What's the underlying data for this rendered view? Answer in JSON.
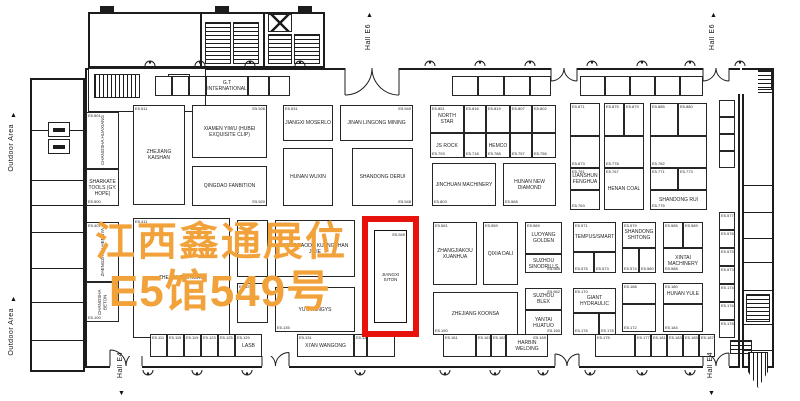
{
  "overlay": {
    "line1": "江西鑫通展位",
    "line2": "E5馆549号"
  },
  "colors": {
    "overlay_text": "#F2A23B",
    "highlight_red": "#E8120D",
    "line": "#1c1c1c"
  },
  "labels": {
    "hall_e6": "Hall E6",
    "hall_e4": "Hall E4",
    "outdoor_area": "Outdoor Area",
    "up_arrow": "▲",
    "down_arrow": "▼"
  },
  "highlight": {
    "num": "E5.549",
    "label": "JIANGXI SITON"
  },
  "booths": [
    {
      "x": 86,
      "y": 112,
      "w": 33,
      "h": 57,
      "label": "CHANGSHA HUAXIANG",
      "num": "E5.501",
      "pos": "tl",
      "vert": 1
    },
    {
      "x": 86,
      "y": 169,
      "w": 33,
      "h": 37,
      "label": "SHARKATE TOOLS (GY. HOPE)",
      "num": "E5.500",
      "pos": "bl"
    },
    {
      "x": 133,
      "y": 105,
      "w": 52,
      "h": 100,
      "label": "ZHEJIANG KAISHAN",
      "num": "E5.511",
      "pos": "tl"
    },
    {
      "x": 192,
      "y": 105,
      "w": 75,
      "h": 53,
      "label": "XIAMEN YIWU (HUBEI EXQUISITE CLIP)",
      "num": "E5.526",
      "pos": "tr"
    },
    {
      "x": 192,
      "y": 166,
      "w": 75,
      "h": 40,
      "label": "QINGDAO FANBITION",
      "num": "E5.520",
      "pos": "br"
    },
    {
      "x": 283,
      "y": 105,
      "w": 50,
      "h": 36,
      "label": "JIANGXI MOSERLO",
      "num": "E5.531",
      "pos": "tl"
    },
    {
      "x": 340,
      "y": 105,
      "w": 73,
      "h": 36,
      "label": "JINAN LINGONG MINING",
      "num": "E5.540",
      "pos": "tr"
    },
    {
      "x": 283,
      "y": 148,
      "w": 50,
      "h": 58,
      "label": "HUNAN WUXIN"
    },
    {
      "x": 352,
      "y": 148,
      "w": 61,
      "h": 58,
      "label": "SHANDONG DERUI",
      "num": "E5.548",
      "pos": "br"
    },
    {
      "x": 430,
      "y": 105,
      "w": 34,
      "h": 28,
      "label": "NORTH STAR",
      "num": "E5.851",
      "pos": "tl"
    },
    {
      "x": 464,
      "y": 105,
      "w": 22,
      "h": 28,
      "num": "E5.816",
      "pos": "tl"
    },
    {
      "x": 486,
      "y": 105,
      "w": 24,
      "h": 28,
      "num": "E5.819",
      "pos": "tl"
    },
    {
      "x": 510,
      "y": 105,
      "w": 22,
      "h": 28,
      "num": "E5.807",
      "pos": "tl"
    },
    {
      "x": 532,
      "y": 105,
      "w": 24,
      "h": 28,
      "num": "E5.802",
      "pos": "tl"
    },
    {
      "x": 430,
      "y": 133,
      "w": 34,
      "h": 25,
      "label": "JS ROCK",
      "num": "E5.793",
      "pos": "bl"
    },
    {
      "x": 464,
      "y": 133,
      "w": 22,
      "h": 25,
      "num": "E5.718",
      "pos": "bl"
    },
    {
      "x": 486,
      "y": 133,
      "w": 24,
      "h": 25,
      "label": "HEMCO",
      "num": "E5.788",
      "pos": "bl"
    },
    {
      "x": 510,
      "y": 133,
      "w": 22,
      "h": 25,
      "num": "E5.757",
      "pos": "bl"
    },
    {
      "x": 532,
      "y": 133,
      "w": 24,
      "h": 25,
      "num": "E5.756",
      "pos": "bl"
    },
    {
      "x": 432,
      "y": 163,
      "w": 64,
      "h": 43,
      "label": "JINCHUAN MACHINERY",
      "num": "E5.803",
      "pos": "bl"
    },
    {
      "x": 503,
      "y": 163,
      "w": 53,
      "h": 43,
      "label": "HUNAN NEW DIAMOND",
      "num": "E5.568",
      "pos": "bl"
    },
    {
      "x": 570,
      "y": 103,
      "w": 30,
      "h": 33,
      "num": "E5.871",
      "pos": "tl"
    },
    {
      "x": 570,
      "y": 136,
      "w": 30,
      "h": 32,
      "num": "E5.873",
      "pos": "bl"
    },
    {
      "x": 604,
      "y": 103,
      "w": 20,
      "h": 33,
      "num": "E5.875",
      "pos": "tl"
    },
    {
      "x": 624,
      "y": 103,
      "w": 20,
      "h": 33,
      "num": "E5.879",
      "pos": "tl"
    },
    {
      "x": 604,
      "y": 136,
      "w": 40,
      "h": 32,
      "num": "E5.778",
      "pos": "bl"
    },
    {
      "x": 650,
      "y": 103,
      "w": 28,
      "h": 33,
      "num": "E5.885",
      "pos": "tl"
    },
    {
      "x": 678,
      "y": 103,
      "w": 29,
      "h": 33,
      "num": "E5.880",
      "pos": "tl"
    },
    {
      "x": 650,
      "y": 136,
      "w": 57,
      "h": 32,
      "num": "E5.782",
      "pos": "bl"
    },
    {
      "x": 570,
      "y": 168,
      "w": 30,
      "h": 22,
      "label": "LIANSHUN FENGHUA",
      "num": "E5.761",
      "pos": "tl"
    },
    {
      "x": 570,
      "y": 190,
      "w": 30,
      "h": 20,
      "num": "E5.763",
      "pos": "bl"
    },
    {
      "x": 604,
      "y": 168,
      "w": 40,
      "h": 42,
      "label": "HENAN COAL",
      "num": "E5.767",
      "pos": "tl"
    },
    {
      "x": 650,
      "y": 168,
      "w": 28,
      "h": 22,
      "num": "E5.771",
      "pos": "tl"
    },
    {
      "x": 678,
      "y": 168,
      "w": 29,
      "h": 22,
      "num": "E5.773",
      "pos": "tl"
    },
    {
      "x": 650,
      "y": 190,
      "w": 57,
      "h": 20,
      "label": "SHANDONG RUI",
      "num": "E5.775",
      "pos": "bl"
    },
    {
      "x": 86,
      "y": 222,
      "w": 33,
      "h": 60,
      "label": "ZHENGZHOU HENGYA",
      "num": "E5.401",
      "pos": "tl",
      "vert": 1
    },
    {
      "x": 86,
      "y": 282,
      "w": 33,
      "h": 40,
      "label": "CHANGSHA BETON",
      "num": "E5.100",
      "pos": "bl",
      "vert": 1
    },
    {
      "x": 133,
      "y": 218,
      "w": 97,
      "h": 120,
      "label": "ZHEJIANG ZHIGAO",
      "num": "E5.411",
      "pos": "tl"
    },
    {
      "x": 237,
      "y": 220,
      "w": 31,
      "h": 57,
      "num": "E5.525",
      "pos": "tl"
    },
    {
      "x": 237,
      "y": 283,
      "w": 31,
      "h": 40,
      "num": "E5.529",
      "pos": "tl"
    },
    {
      "x": 275,
      "y": 220,
      "w": 80,
      "h": 57,
      "label": "WANGJIAODU KUANGSHAN JIXIE",
      "num": "E5.537",
      "pos": "tl"
    },
    {
      "x": 275,
      "y": 287,
      "w": 80,
      "h": 45,
      "label": "YUTA XINGYS",
      "num": "E5.135",
      "pos": "bl"
    },
    {
      "x": 433,
      "y": 222,
      "w": 44,
      "h": 63,
      "label": "ZHANGJIAKOU XUANHUA",
      "num": "E5.561",
      "pos": "tl"
    },
    {
      "x": 483,
      "y": 222,
      "w": 35,
      "h": 63,
      "label": "QIXIA DALI",
      "num": "E5.559",
      "pos": "tl"
    },
    {
      "x": 525,
      "y": 222,
      "w": 37,
      "h": 32,
      "label": "LUOYANG GOLDEN",
      "num": "E5.569",
      "pos": "tl"
    },
    {
      "x": 525,
      "y": 254,
      "w": 37,
      "h": 19,
      "label": "SUZHOU SINODRILLS",
      "num": "E5.565",
      "pos": "br"
    },
    {
      "x": 573,
      "y": 222,
      "w": 43,
      "h": 30,
      "label": "TEMPUS/SMART",
      "num": "E5.571",
      "pos": "tl"
    },
    {
      "x": 573,
      "y": 252,
      "w": 21,
      "h": 21,
      "num": "E5.575",
      "pos": "bl"
    },
    {
      "x": 594,
      "y": 252,
      "w": 22,
      "h": 21,
      "num": "E5.573",
      "pos": "bl"
    },
    {
      "x": 433,
      "y": 292,
      "w": 85,
      "h": 43,
      "label": "ZHEJIANG KOONSA",
      "num": "E5.150",
      "pos": "bl"
    },
    {
      "x": 525,
      "y": 288,
      "w": 37,
      "h": 22,
      "label": "SUZHOU BLEX",
      "num": "E5.562",
      "pos": "tr"
    },
    {
      "x": 525,
      "y": 310,
      "w": 37,
      "h": 25,
      "label": "YANTAI HUATUO",
      "num": "E5.160",
      "pos": "br"
    },
    {
      "x": 573,
      "y": 288,
      "w": 43,
      "h": 25,
      "label": "GIANT HYDRAULIC",
      "num": "E5.170",
      "pos": "tl"
    },
    {
      "x": 573,
      "y": 313,
      "w": 26,
      "h": 22,
      "num": "E5.176",
      "pos": "bl"
    },
    {
      "x": 599,
      "y": 313,
      "w": 17,
      "h": 22,
      "num": "E5.178",
      "pos": "bl"
    },
    {
      "x": 622,
      "y": 222,
      "w": 34,
      "h": 26,
      "label": "SHANDONG SHITONG",
      "num": "E5.579",
      "pos": "tl"
    },
    {
      "x": 622,
      "y": 248,
      "w": 17,
      "h": 25,
      "num": "E5.574",
      "pos": "bl"
    },
    {
      "x": 639,
      "y": 248,
      "w": 17,
      "h": 25,
      "num": "E5.580",
      "pos": "bl"
    },
    {
      "x": 663,
      "y": 222,
      "w": 20,
      "h": 26,
      "num": "E5.585",
      "pos": "tl"
    },
    {
      "x": 683,
      "y": 222,
      "w": 20,
      "h": 26,
      "num": "E5.589",
      "pos": "tl"
    },
    {
      "x": 663,
      "y": 248,
      "w": 40,
      "h": 25,
      "label": "XINTAI MACHINERY",
      "num": "E5.588",
      "pos": "bl"
    },
    {
      "x": 622,
      "y": 283,
      "w": 34,
      "h": 21,
      "num": "E5.168",
      "pos": "tl"
    },
    {
      "x": 622,
      "y": 304,
      "w": 34,
      "h": 28,
      "num": "E5.172",
      "pos": "bl"
    },
    {
      "x": 663,
      "y": 283,
      "w": 40,
      "h": 21,
      "label": "HUNAN YULE",
      "num": "E5.180",
      "pos": "tl"
    },
    {
      "x": 663,
      "y": 304,
      "w": 40,
      "h": 28,
      "num": "E5.184",
      "pos": "bl"
    },
    {
      "x": 155,
      "y": 76,
      "w": 17,
      "h": 20
    },
    {
      "x": 172,
      "y": 76,
      "w": 17,
      "h": 20
    },
    {
      "x": 189,
      "y": 76,
      "w": 17,
      "h": 20
    },
    {
      "x": 206,
      "y": 76,
      "w": 42,
      "h": 20,
      "label": "G.T INTERNATIONAL"
    },
    {
      "x": 248,
      "y": 76,
      "w": 21,
      "h": 20
    },
    {
      "x": 269,
      "y": 76,
      "w": 21,
      "h": 20
    },
    {
      "x": 452,
      "y": 76,
      "w": 26,
      "h": 20
    },
    {
      "x": 478,
      "y": 76,
      "w": 26,
      "h": 20
    },
    {
      "x": 504,
      "y": 76,
      "w": 26,
      "h": 20
    },
    {
      "x": 530,
      "y": 76,
      "w": 21,
      "h": 20
    },
    {
      "x": 580,
      "y": 76,
      "w": 25,
      "h": 20
    },
    {
      "x": 605,
      "y": 76,
      "w": 25,
      "h": 20
    },
    {
      "x": 630,
      "y": 76,
      "w": 25,
      "h": 20
    },
    {
      "x": 655,
      "y": 76,
      "w": 25,
      "h": 20
    },
    {
      "x": 680,
      "y": 76,
      "w": 23,
      "h": 20
    },
    {
      "x": 150,
      "y": 334,
      "w": 17,
      "h": 23,
      "num": "E5.111",
      "pos": "tl"
    },
    {
      "x": 167,
      "y": 334,
      "w": 17,
      "h": 23,
      "num": "E5.115",
      "pos": "tl"
    },
    {
      "x": 184,
      "y": 334,
      "w": 17,
      "h": 23,
      "num": "E5.119",
      "pos": "tl"
    },
    {
      "x": 201,
      "y": 334,
      "w": 17,
      "h": 23,
      "num": "E5.123",
      "pos": "tl"
    },
    {
      "x": 218,
      "y": 334,
      "w": 17,
      "h": 23,
      "num": "E5.125",
      "pos": "tl"
    },
    {
      "x": 235,
      "y": 334,
      "w": 27,
      "h": 23,
      "label": "LASB",
      "num": "E5.129",
      "pos": "tl"
    },
    {
      "x": 297,
      "y": 334,
      "w": 57,
      "h": 23,
      "label": "XI'AN WANGONG",
      "num": "E5.131",
      "pos": "tl"
    },
    {
      "x": 354,
      "y": 334,
      "w": 13,
      "h": 23,
      "num": "E5.139",
      "pos": "tl"
    },
    {
      "x": 367,
      "y": 334,
      "w": 28,
      "h": 23
    },
    {
      "x": 443,
      "y": 334,
      "w": 33,
      "h": 23,
      "num": "E5.161",
      "pos": "tl"
    },
    {
      "x": 476,
      "y": 334,
      "w": 15,
      "h": 23,
      "num": "E5.167",
      "pos": "tl"
    },
    {
      "x": 491,
      "y": 334,
      "w": 15,
      "h": 23,
      "num": "E5.163",
      "pos": "tl"
    },
    {
      "x": 506,
      "y": 334,
      "w": 42,
      "h": 23,
      "label": "HARBIN WELDING",
      "num": "E5.169",
      "pos": "tr"
    },
    {
      "x": 595,
      "y": 334,
      "w": 40,
      "h": 23,
      "num": "E5.175",
      "pos": "tl"
    },
    {
      "x": 635,
      "y": 334,
      "w": 16,
      "h": 23,
      "num": "E5.177",
      "pos": "tl"
    },
    {
      "x": 651,
      "y": 334,
      "w": 16,
      "h": 23,
      "num": "E5.181",
      "pos": "tl"
    },
    {
      "x": 667,
      "y": 334,
      "w": 16,
      "h": 23,
      "num": "E5.183",
      "pos": "tl"
    },
    {
      "x": 683,
      "y": 334,
      "w": 16,
      "h": 23,
      "num": "E5.185",
      "pos": "tl"
    },
    {
      "x": 699,
      "y": 334,
      "w": 16,
      "h": 23,
      "num": "E5.187",
      "pos": "tl"
    },
    {
      "x": 719,
      "y": 100,
      "w": 16,
      "h": 17
    },
    {
      "x": 719,
      "y": 117,
      "w": 16,
      "h": 17
    },
    {
      "x": 719,
      "y": 134,
      "w": 16,
      "h": 17
    },
    {
      "x": 719,
      "y": 151,
      "w": 16,
      "h": 17
    },
    {
      "x": 719,
      "y": 212,
      "w": 16,
      "h": 18,
      "num": "E5.577",
      "pos": "tl"
    },
    {
      "x": 719,
      "y": 230,
      "w": 16,
      "h": 18,
      "num": "E5.576",
      "pos": "tl"
    },
    {
      "x": 719,
      "y": 248,
      "w": 16,
      "h": 18,
      "num": "E5.575",
      "pos": "tl"
    },
    {
      "x": 719,
      "y": 266,
      "w": 16,
      "h": 18,
      "num": "E5.573",
      "pos": "tl"
    },
    {
      "x": 719,
      "y": 284,
      "w": 16,
      "h": 18,
      "num": "E5.174",
      "pos": "tl"
    },
    {
      "x": 719,
      "y": 302,
      "w": 16,
      "h": 18,
      "num": "E5.176",
      "pos": "tl"
    },
    {
      "x": 719,
      "y": 320,
      "w": 16,
      "h": 18,
      "num": "E5.178",
      "pos": "tl"
    }
  ],
  "doors_top": [
    {
      "x": 345,
      "w": 54
    },
    {
      "x": 551,
      "w": 26
    },
    {
      "x": 703,
      "w": 26
    }
  ],
  "doors_bottom": [
    {
      "x": 110,
      "w": 32
    },
    {
      "x": 262,
      "w": 27
    },
    {
      "x": 555,
      "w": 24
    },
    {
      "x": 703,
      "w": 26
    }
  ],
  "lights_top": [
    150,
    200,
    250,
    300,
    430,
    480,
    530,
    592,
    642,
    690,
    740
  ],
  "lights_bottom": [
    148,
    197,
    247,
    360,
    445,
    495,
    543,
    590,
    642,
    690
  ],
  "boxes_top": [
    305,
    427,
    738
  ],
  "boxes_bottom": [
    127,
    258,
    420
  ]
}
